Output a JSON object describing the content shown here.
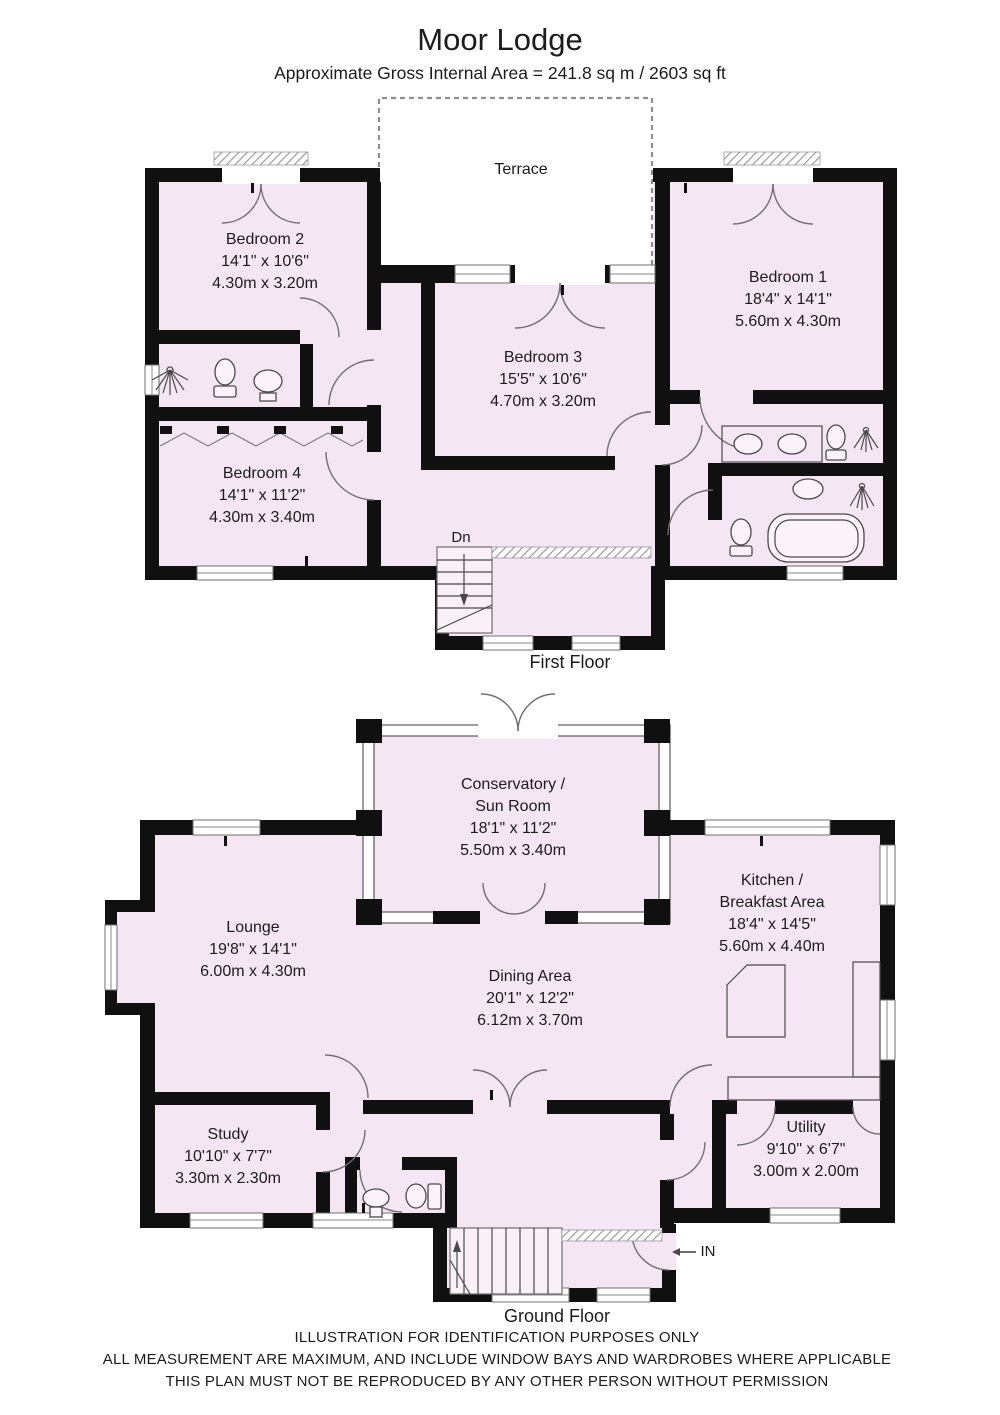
{
  "header": {
    "title": "Moor Lodge",
    "subtitle": "Approximate Gross Internal Area = 241.8 sq m / 2603 sq ft"
  },
  "floors": {
    "first": {
      "label": "First Floor",
      "stairs_label": "Dn",
      "rooms": {
        "terrace": {
          "name": "Terrace"
        },
        "bedroom2": {
          "name": "Bedroom 2",
          "imperial": "14'1\" x 10'6\"",
          "metric": "4.30m x 3.20m"
        },
        "bedroom1": {
          "name": "Bedroom 1",
          "imperial": "18'4\" x 14'1\"",
          "metric": "5.60m x 4.30m"
        },
        "bedroom3": {
          "name": "Bedroom 3",
          "imperial": "15'5\" x 10'6\"",
          "metric": "4.70m x 3.20m"
        },
        "bedroom4": {
          "name": "Bedroom 4",
          "imperial": "14'1\" x 11'2\"",
          "metric": "4.30m x 3.40m"
        }
      }
    },
    "ground": {
      "label": "Ground Floor",
      "entrance_label": "IN",
      "rooms": {
        "conservatory": {
          "name_line1": "Conservatory /",
          "name_line2": "Sun Room",
          "imperial": "18'1\" x 11'2\"",
          "metric": "5.50m x 3.40m"
        },
        "lounge": {
          "name": "Lounge",
          "imperial": "19'8\" x 14'1\"",
          "metric": "6.00m x 4.30m"
        },
        "kitchen": {
          "name_line1": "Kitchen /",
          "name_line2": "Breakfast Area",
          "imperial": "18'4\" x 14'5\"",
          "metric": "5.60m x 4.40m"
        },
        "dining": {
          "name": "Dining Area",
          "imperial": "20'1\" x 12'2\"",
          "metric": "6.12m x 3.70m"
        },
        "study": {
          "name": "Study",
          "imperial": "10'10\" x 7'7\"",
          "metric": "3.30m x 2.30m"
        },
        "utility": {
          "name": "Utility",
          "imperial": "9'10\" x 6'7\"",
          "metric": "3.00m x 2.00m"
        }
      }
    }
  },
  "footer": {
    "line1": "ILLUSTRATION FOR IDENTIFICATION PURPOSES ONLY",
    "line2": "ALL MEASUREMENT  ARE MAXIMUM, AND INCLUDE WINDOW BAYS AND WARDROBES WHERE APPLICABLE",
    "line3": "THIS PLAN MUST NOT BE REPRODUCED BY ANY OTHER PERSON WITHOUT PERMISSION"
  }
}
